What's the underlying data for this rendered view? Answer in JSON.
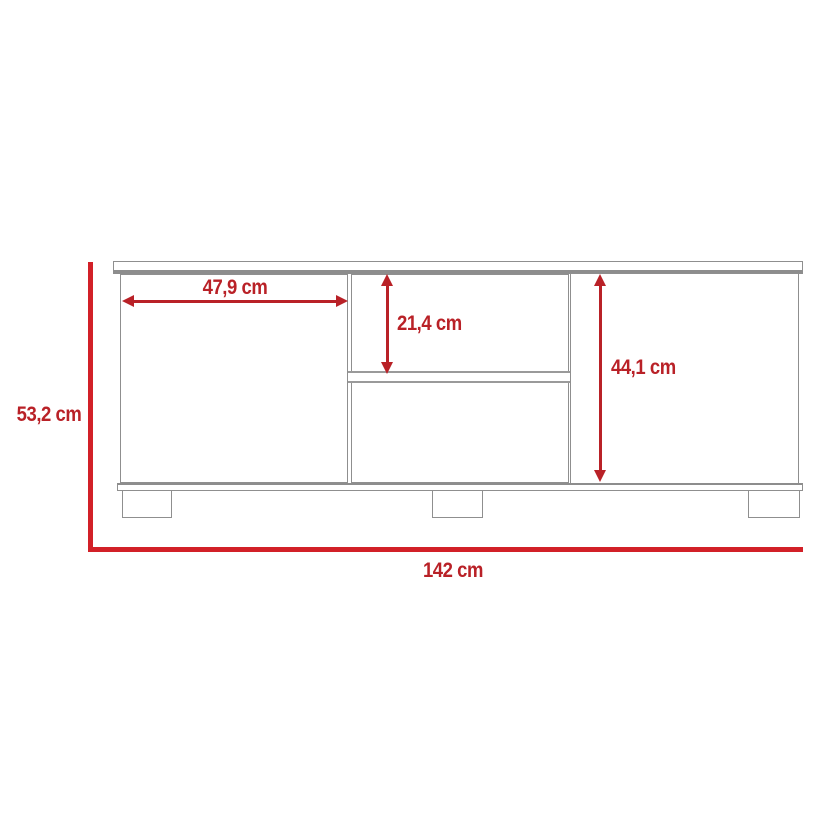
{
  "diagram": {
    "type": "furniture-dimension-drawing",
    "subject": "tv-stand-front-view",
    "dimensions": {
      "left_door_width": "47,9 cm",
      "middle_upper_compartment_height": "21,4 cm",
      "right_door_height": "44,1 cm",
      "overall_height": "53,2 cm",
      "overall_width": "142 cm"
    },
    "colors": {
      "dimension_arrow_red": "#b92127",
      "dimension_frame_red": "#d22028",
      "furniture_outline_gray": "#8f8f8f",
      "background": "#ffffff"
    }
  }
}
